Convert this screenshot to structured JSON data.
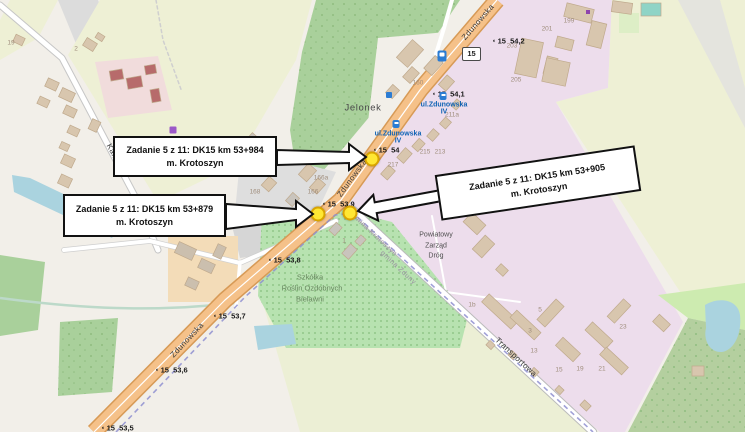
{
  "map": {
    "title": "DK15 Krotoszyn task locations map",
    "route_shield": {
      "text": "15"
    },
    "callouts": [
      {
        "line1": "Zadanie 5 z 11: DK15 km 53+984",
        "line2": "m. Krotoszyn"
      },
      {
        "line1": "Zadanie 5 z 11: DK15 km 53+879",
        "line2": "m. Krotoszyn"
      },
      {
        "line1": "Zadanie 5 z 11: DK15 km 53+905",
        "line2": "m. Krotoszyn"
      }
    ],
    "markers": [
      {
        "x": 372,
        "y": 159,
        "label": "DK15 km 53+984"
      },
      {
        "x": 318,
        "y": 214,
        "label": "DK15 km 53+879"
      },
      {
        "x": 350,
        "y": 213,
        "label": "DK15 km 53+905"
      }
    ],
    "km_markers": [
      {
        "route": "15",
        "value": "54,2",
        "x": 492,
        "y": 41
      },
      {
        "route": "15",
        "value": "54,1",
        "x": 432,
        "y": 94
      },
      {
        "route": "15",
        "value": "54",
        "x": 373,
        "y": 150
      },
      {
        "route": "15",
        "value": "53,9",
        "x": 322,
        "y": 204
      },
      {
        "route": "15",
        "value": "53,8",
        "x": 268,
        "y": 260
      },
      {
        "route": "15",
        "value": "53,7",
        "x": 213,
        "y": 316
      },
      {
        "route": "15",
        "value": "53,6",
        "x": 155,
        "y": 370
      },
      {
        "route": "15",
        "value": "53,5",
        "x": 101,
        "y": 428
      }
    ],
    "street_labels": [
      {
        "text": "Zdunowska",
        "x": 478,
        "y": 22,
        "rot": -49,
        "cls": "street"
      },
      {
        "text": "Zdunowska",
        "x": 352,
        "y": 178,
        "rot": -54,
        "cls": "street"
      },
      {
        "text": "Zdunowska",
        "x": 187,
        "y": 340,
        "rot": -47,
        "cls": "street"
      },
      {
        "text": "Kalinowa",
        "x": 117,
        "y": 160,
        "rot": 62,
        "cls": "street"
      },
      {
        "text": "Transportowa",
        "x": 516,
        "y": 357,
        "rot": 43,
        "cls": "street"
      },
      {
        "text": "gmina Krotoszyn",
        "x": 374,
        "y": 235,
        "rot": 43,
        "cls": "admin"
      },
      {
        "text": "gmina Zduny",
        "x": 398,
        "y": 268,
        "rot": 43,
        "cls": "admin"
      }
    ],
    "place_labels": [
      {
        "text": "Jelonek",
        "x": 363,
        "y": 108,
        "rot": 0,
        "cls": "place"
      },
      {
        "text": "Szkółka",
        "x": 310,
        "y": 277,
        "rot": 0,
        "cls": "green"
      },
      {
        "text": "Roślin Ozdobnych",
        "x": 312,
        "y": 288,
        "rot": 0,
        "cls": "green"
      },
      {
        "text": "Bielawni",
        "x": 310,
        "y": 299,
        "rot": 0,
        "cls": "green"
      },
      {
        "text": "Powiatowy",
        "x": 436,
        "y": 235,
        "rot": 0,
        "cls": "poi"
      },
      {
        "text": "Zarząd",
        "x": 436,
        "y": 246,
        "rot": 0,
        "cls": "poi"
      },
      {
        "text": "Dróg",
        "x": 436,
        "y": 256,
        "rot": 0,
        "cls": "poi"
      }
    ],
    "bus_stops": [
      {
        "line1": "ul.Zdunowska",
        "line2": "IV",
        "tx": 398,
        "ty": 134,
        "ix": 396,
        "iy": 124
      },
      {
        "line1": "ul.Zdunowska",
        "line2": "IV",
        "tx": 444,
        "ty": 105,
        "ix": 443,
        "iy": 96
      }
    ],
    "poi_icons": [
      {
        "name": "fuel-station-icon",
        "cls": "ico-fuel",
        "x": 442,
        "y": 56
      },
      {
        "name": "info-icon",
        "cls": "ico-info",
        "x": 389,
        "y": 95
      },
      {
        "name": "supermarket-icon",
        "cls": "ico-cart",
        "x": 173,
        "y": 130
      },
      {
        "name": "shop-icon",
        "cls": "ico-dot",
        "x": 588,
        "y": 12
      }
    ],
    "house_numbers": [
      [
        "19",
        11,
        43
      ],
      [
        "2",
        76,
        49
      ],
      [
        "166a",
        321,
        178
      ],
      [
        "166",
        313,
        192
      ],
      [
        "168",
        255,
        192
      ],
      [
        "217",
        393,
        165
      ],
      [
        "215",
        425,
        152
      ],
      [
        "213",
        440,
        152
      ],
      [
        "211a",
        452,
        115
      ],
      [
        "160",
        418,
        83
      ],
      [
        "199",
        569,
        21
      ],
      [
        "201",
        547,
        29
      ],
      [
        "203",
        512,
        46
      ],
      [
        "205",
        516,
        80
      ],
      [
        "1",
        344,
        241
      ],
      [
        "1b",
        472,
        305
      ],
      [
        "5",
        540,
        310
      ],
      [
        "3",
        530,
        331
      ],
      [
        "13",
        534,
        351
      ],
      [
        "15",
        559,
        370
      ],
      [
        "19",
        580,
        369
      ],
      [
        "21",
        602,
        369
      ],
      [
        "23",
        623,
        327
      ]
    ],
    "buildings": [
      [
        14,
        36,
        10,
        8,
        25
      ],
      [
        84,
        40,
        12,
        9,
        32
      ],
      [
        96,
        34,
        8,
        6,
        32
      ],
      [
        46,
        80,
        12,
        9,
        25
      ],
      [
        60,
        90,
        14,
        10,
        25
      ],
      [
        38,
        98,
        11,
        8,
        25
      ],
      [
        64,
        107,
        12,
        9,
        25
      ],
      [
        90,
        120,
        9,
        11,
        25
      ],
      [
        68,
        127,
        11,
        8,
        25
      ],
      [
        60,
        143,
        9,
        7,
        25
      ],
      [
        62,
        156,
        12,
        10,
        25
      ],
      [
        59,
        176,
        12,
        10,
        25
      ],
      [
        110,
        70,
        13,
        10,
        -10,
        "#b76b6b"
      ],
      [
        127,
        77,
        15,
        11,
        -10,
        "#b76b6b"
      ],
      [
        145,
        65,
        11,
        9,
        -10,
        "#b76b6b"
      ],
      [
        151,
        89,
        9,
        13,
        -10,
        "#b76b6b"
      ],
      [
        398,
        46,
        24,
        15,
        -48
      ],
      [
        425,
        60,
        17,
        11,
        -48
      ],
      [
        440,
        78,
        13,
        10,
        -48
      ],
      [
        387,
        87,
        11,
        9,
        -48
      ],
      [
        404,
        70,
        14,
        10,
        -48
      ],
      [
        565,
        6,
        28,
        14,
        14
      ],
      [
        589,
        22,
        15,
        25,
        14
      ],
      [
        556,
        38,
        17,
        11,
        14
      ],
      [
        545,
        57,
        11,
        18,
        14
      ],
      [
        518,
        40,
        22,
        36,
        12
      ],
      [
        544,
        60,
        24,
        24,
        12
      ],
      [
        612,
        2,
        20,
        11,
        8
      ],
      [
        641,
        3,
        20,
        13,
        0,
        "#8fd4c6"
      ],
      [
        300,
        167,
        15,
        11,
        -48
      ],
      [
        311,
        181,
        13,
        10,
        -48
      ],
      [
        263,
        179,
        12,
        10,
        -48
      ],
      [
        287,
        195,
        11,
        9,
        -48,
        "#c9c4bd"
      ],
      [
        247,
        135,
        10,
        8,
        -48,
        "#c9c4bd"
      ],
      [
        382,
        168,
        12,
        9,
        -48
      ],
      [
        398,
        151,
        13,
        9,
        -48
      ],
      [
        413,
        141,
        11,
        8,
        -48
      ],
      [
        428,
        131,
        10,
        8,
        -48
      ],
      [
        441,
        119,
        9,
        8,
        -48
      ],
      [
        452,
        101,
        9,
        7,
        -48
      ],
      [
        176,
        245,
        19,
        12,
        25,
        "#cbbfae"
      ],
      [
        199,
        261,
        15,
        10,
        25,
        "#cbbfae"
      ],
      [
        186,
        279,
        12,
        9,
        25,
        "#cbbfae"
      ],
      [
        215,
        245,
        9,
        13,
        25,
        "#cbbfae"
      ],
      [
        330,
        225,
        11,
        8,
        -48,
        "#c9c4bd"
      ],
      [
        343,
        247,
        13,
        9,
        -48,
        "#c9c4bd"
      ],
      [
        356,
        237,
        9,
        7,
        -48,
        "#c9c4bd"
      ],
      [
        465,
        217,
        19,
        13,
        43
      ],
      [
        477,
        237,
        13,
        19,
        43
      ],
      [
        497,
        266,
        10,
        8,
        43
      ],
      [
        480,
        306,
        40,
        11,
        43
      ],
      [
        509,
        320,
        33,
        10,
        43
      ],
      [
        545,
        299,
        11,
        28,
        43
      ],
      [
        556,
        344,
        24,
        11,
        43
      ],
      [
        585,
        330,
        28,
        11,
        43
      ],
      [
        599,
        356,
        30,
        10,
        43
      ],
      [
        614,
        299,
        10,
        24,
        43
      ],
      [
        654,
        318,
        15,
        10,
        43
      ],
      [
        487,
        342,
        7,
        6,
        43
      ],
      [
        509,
        352,
        7,
        6,
        43
      ],
      [
        531,
        369,
        7,
        6,
        43
      ],
      [
        556,
        387,
        7,
        6,
        43
      ],
      [
        581,
        402,
        9,
        7,
        43
      ],
      [
        692,
        366,
        12,
        10,
        0
      ]
    ],
    "colors": {
      "background": "#f2efe9",
      "trunk_road": "#f5c189",
      "trunk_casing": "#d79a56",
      "field": "#eef0d5",
      "forest": "#a9d09b",
      "nursery": "#b7e2b0",
      "industrial": "#edddec",
      "residential_gray": "#dedede",
      "farmyard": "#f3dcb8",
      "water": "#aad3df",
      "boundary": "#8f8fd0",
      "marker_fill": "#ffe733",
      "marker_border": "#d9a400"
    }
  }
}
